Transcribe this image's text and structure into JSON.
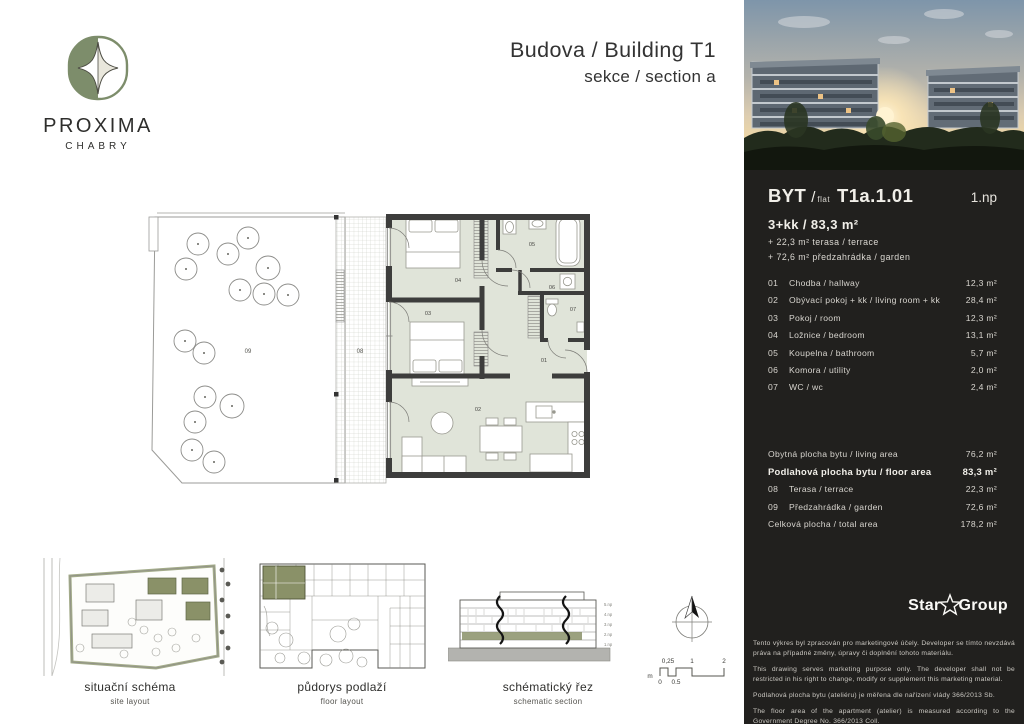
{
  "brand": {
    "name": "PROXIMA",
    "city": "CHABRY"
  },
  "header": {
    "title": "Budova / Building T1",
    "subtitle": "sekce / section a"
  },
  "plan_labels": {
    "hallway": "01",
    "living": "02",
    "room": "03",
    "bedroom": "04",
    "bathroom": "05",
    "utility": "06",
    "wc": "07",
    "terrace": "08",
    "garden": "09"
  },
  "diagrams": {
    "site": {
      "title": "situační schéma",
      "subtitle": "site layout"
    },
    "floor": {
      "title": "půdorys podlaží",
      "subtitle": "floor layout"
    },
    "section": {
      "title": "schématický řez",
      "subtitle": "schematic section"
    },
    "section_floors": [
      "5.np",
      "4.np",
      "3.np",
      "2.np",
      "1.np"
    ]
  },
  "scalebar": {
    "unit": "m",
    "top": [
      "0,25",
      "1",
      "2"
    ],
    "bottom": [
      "0",
      "0,5"
    ]
  },
  "panel": {
    "flat_word": "BYT",
    "flat_sep": "/",
    "flat_sub": "flat",
    "flat_code": "T1a.1.01",
    "floor_label": "1.np",
    "disposition": "3+kk / 83,3 m²",
    "extras": [
      "+ 22,3 m² terasa / terrace",
      "+ 72,6 m² předzahrádka / garden"
    ],
    "rooms": [
      {
        "num": "01",
        "name": "Chodba / hallway",
        "area": "12,3 m²"
      },
      {
        "num": "02",
        "name": "Obývací pokoj + kk / living room + kk",
        "area": "28,4 m²"
      },
      {
        "num": "03",
        "name": "Pokoj / room",
        "area": "12,3 m²"
      },
      {
        "num": "04",
        "name": "Ložnice / bedroom",
        "area": "13,1 m²"
      },
      {
        "num": "05",
        "name": "Koupelna / bathroom",
        "area": "5,7 m²"
      },
      {
        "num": "06",
        "name": "Komora / utility",
        "area": "2,0 m²"
      },
      {
        "num": "07",
        "name": "WC / wc",
        "area": "2,4 m²"
      }
    ],
    "summary": [
      {
        "num": "",
        "name": "Obytná plocha bytu / living area",
        "area": "76,2 m²"
      },
      {
        "num": "",
        "name": "Podlahová plocha bytu / floor area",
        "area": "83,3 m²"
      },
      {
        "num": "08",
        "name": "Terasa / terrace",
        "area": "22,3 m²"
      },
      {
        "num": "09",
        "name": "Předzahrádka / garden",
        "area": "72,6 m²"
      },
      {
        "num": "",
        "name": "Celková plocha / total area",
        "area": "178,2 m²"
      }
    ],
    "logo_left": "Star",
    "logo_right": "Group",
    "disclaimers": [
      "Tento výkres byl zpracován pro marketingové účely. Developer se tímto nevzdává práva na případné změny, úpravy či doplnění tohoto materiálu.",
      "This drawing serves marketing purpose only. The developer shall not be restricted in his right to change, modify or supplement this marketing material.",
      "Podlahová plocha bytu (ateliéru) je měřena dle nařízení vlády 366/2013 Sb.",
      "The floor area of the apartment (atelier) is measured according to the Government Degree No. 366/2013 Coll."
    ]
  },
  "colors": {
    "panel_bg": "#21201e",
    "room_fill": "#e0e4d9",
    "wall": "#3d3d3c",
    "olive": "#8a9168",
    "logo_green": "#7d8d6b"
  }
}
